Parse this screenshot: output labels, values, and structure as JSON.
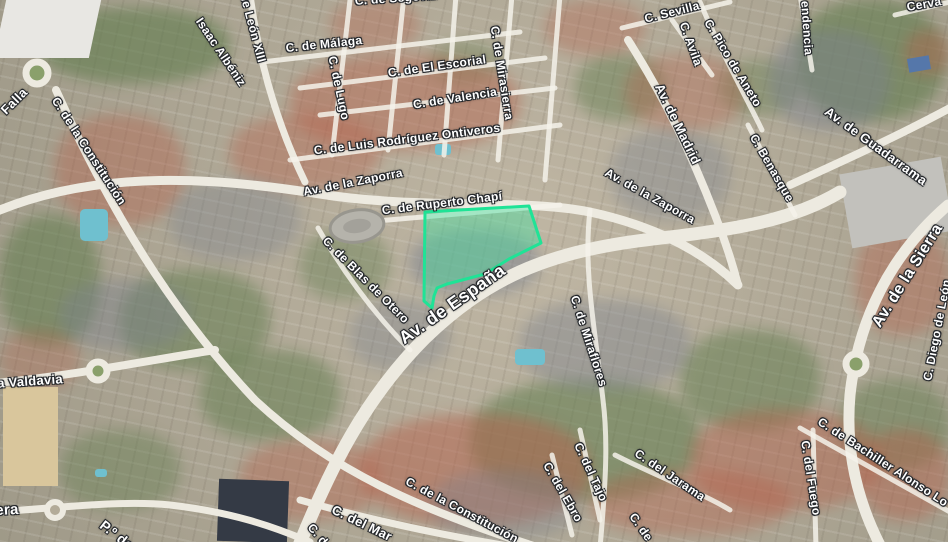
{
  "map": {
    "kind": "satellite-map-view",
    "label_color": "#ffffff",
    "label_outline_color": "#24272b",
    "highlight": {
      "description": "highlighted parcel polygon",
      "fill": "#3de3a0",
      "fill_opacity": 0.42,
      "stroke": "#1fe396",
      "stroke_width": 3,
      "points": [
        [
          425,
          212
        ],
        [
          529,
          206
        ],
        [
          541,
          243
        ],
        [
          509,
          259
        ],
        [
          485,
          274
        ],
        [
          447,
          284
        ],
        [
          437,
          288
        ],
        [
          434,
          296
        ],
        [
          432,
          308
        ],
        [
          424,
          301
        ]
      ]
    },
    "street_labels": [
      {
        "text": "Falla",
        "x": 14,
        "y": 101,
        "rot": -45,
        "size": 13
      },
      {
        "text": "C. de la Constitución",
        "x": 89,
        "y": 151,
        "rot": 57,
        "size": 12
      },
      {
        "text": "de León XIII",
        "x": 253,
        "y": 28,
        "rot": 75,
        "size": 12
      },
      {
        "text": "Isaac Albéniz",
        "x": 221,
        "y": 52,
        "rot": 56,
        "size": 12
      },
      {
        "text": "C. de Málaga",
        "x": 324,
        "y": 44,
        "rot": -6,
        "size": 12
      },
      {
        "text": "C. de Segovia",
        "x": 396,
        "y": -2,
        "rot": -4,
        "size": 12
      },
      {
        "text": "C. de Lugo",
        "x": 339,
        "y": 88,
        "rot": 78,
        "size": 12
      },
      {
        "text": "C. de El Escorial",
        "x": 437,
        "y": 66,
        "rot": -8,
        "size": 12
      },
      {
        "text": "C. de Valencia",
        "x": 455,
        "y": 98,
        "rot": -9,
        "size": 12
      },
      {
        "text": "C. de Luis Rodríguez Ontiveros",
        "x": 407,
        "y": 139,
        "rot": -7,
        "size": 12
      },
      {
        "text": "C. de Mirasierra",
        "x": 502,
        "y": 73,
        "rot": 81,
        "size": 12
      },
      {
        "text": "C. Sevilla",
        "x": 672,
        "y": 12,
        "rot": -14,
        "size": 12
      },
      {
        "text": "C. Avila",
        "x": 691,
        "y": 44,
        "rot": 70,
        "size": 12
      },
      {
        "text": "C. Pico de Aneto",
        "x": 733,
        "y": 63,
        "rot": 59,
        "size": 12
      },
      {
        "text": "endencia",
        "x": 807,
        "y": 28,
        "rot": 86,
        "size": 12
      },
      {
        "text": "Cerva",
        "x": 924,
        "y": 4,
        "rot": -10,
        "size": 12
      },
      {
        "text": "Av. de Madrid",
        "x": 678,
        "y": 124,
        "rot": 64,
        "size": 13
      },
      {
        "text": "Av. de Guadarrama",
        "x": 876,
        "y": 146,
        "rot": 36,
        "size": 13
      },
      {
        "text": "Av. de la Zaporra",
        "x": 353,
        "y": 182,
        "rot": -11,
        "size": 12
      },
      {
        "text": "Av. de la Zaporra",
        "x": 650,
        "y": 196,
        "rot": 29,
        "size": 12
      },
      {
        "text": "C. de Ruperto Chapí",
        "x": 442,
        "y": 203,
        "rot": -7,
        "size": 12
      },
      {
        "text": "C. Benasque",
        "x": 772,
        "y": 168,
        "rot": 60,
        "size": 12
      },
      {
        "text": "C. de Blas de Otero",
        "x": 366,
        "y": 280,
        "rot": 45,
        "size": 12
      },
      {
        "text": "Av. de España",
        "x": 452,
        "y": 304,
        "rot": -35,
        "size": 18
      },
      {
        "text": "Av. de la Sierra",
        "x": 908,
        "y": 276,
        "rot": -58,
        "size": 16
      },
      {
        "text": "C. Diego de León",
        "x": 937,
        "y": 330,
        "rot": -79,
        "size": 12
      },
      {
        "text": "C. de Miraflores",
        "x": 589,
        "y": 341,
        "rot": 72,
        "size": 12
      },
      {
        "text": "a Valdavia",
        "x": 30,
        "y": 381,
        "rot": -4,
        "size": 13
      },
      {
        "text": "era",
        "x": 7,
        "y": 510,
        "rot": -3,
        "size": 15
      },
      {
        "text": "P.º de",
        "x": 117,
        "y": 535,
        "rot": 38,
        "size": 14
      },
      {
        "text": "C. del Mar",
        "x": 362,
        "y": 523,
        "rot": 26,
        "size": 13
      },
      {
        "text": "C. de",
        "x": 320,
        "y": 537,
        "rot": 50,
        "size": 12
      },
      {
        "text": "C. de la Constitución",
        "x": 462,
        "y": 510,
        "rot": 28,
        "size": 12
      },
      {
        "text": "C. del Ebro",
        "x": 563,
        "y": 492,
        "rot": 60,
        "size": 12
      },
      {
        "text": "C. del Tajo",
        "x": 591,
        "y": 472,
        "rot": 65,
        "size": 12
      },
      {
        "text": "C. del Jarama",
        "x": 670,
        "y": 475,
        "rot": 34,
        "size": 12
      },
      {
        "text": "C. de",
        "x": 641,
        "y": 527,
        "rot": 55,
        "size": 12
      },
      {
        "text": "C. del Fuego",
        "x": 811,
        "y": 478,
        "rot": 81,
        "size": 12
      },
      {
        "text": "C. de Bachiller Alonso Lo",
        "x": 883,
        "y": 462,
        "rot": 33,
        "size": 12
      }
    ]
  }
}
